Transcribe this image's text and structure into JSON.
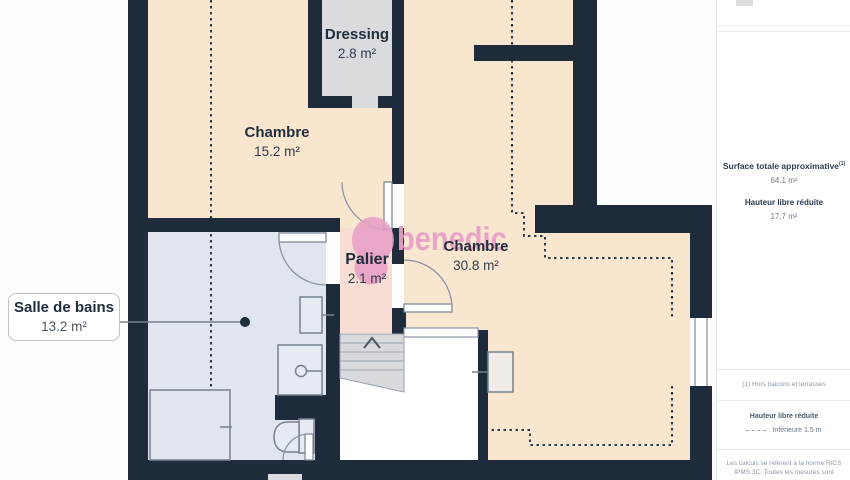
{
  "plan": {
    "watermark_text": "benedic",
    "rooms": {
      "dressing": {
        "name": "Dressing",
        "area": "2.8 m²"
      },
      "chambre1": {
        "name": "Chambre",
        "area": "15.2 m²"
      },
      "chambre2": {
        "name": "Chambre",
        "area": "30.8 m²"
      },
      "palier": {
        "name": "Palier",
        "area": "2.1 m²"
      },
      "salle_de_bains": {
        "name": "Salle de bains",
        "area": "13.2 m²"
      }
    },
    "colors": {
      "wall": "#1e2b3a",
      "room_default": "#f9e6cf",
      "room_highlight": "#f8ddd4",
      "room_bathroom": "#e0e5ef",
      "room_dressing": "#d9dbdf",
      "watermark_pink": "#e79fc5"
    }
  },
  "sidebar": {
    "surface_label": "Surface totale approximative",
    "surface_sup": "(1)",
    "surface_value": "64.1 m²",
    "height_label": "Hauteur libre réduite",
    "height_value": "17.7 m²",
    "footnote": "(1) Hors balcons et terrasses",
    "legend_title": "Hauteur libre réduite",
    "legend_value": "Inférieure 1.5 m",
    "disclaimer_line1": "Les calculs se réfèrent à la norme RICS",
    "disclaimer_line2": "IPMS 3C. Toutes les mesures sont"
  }
}
